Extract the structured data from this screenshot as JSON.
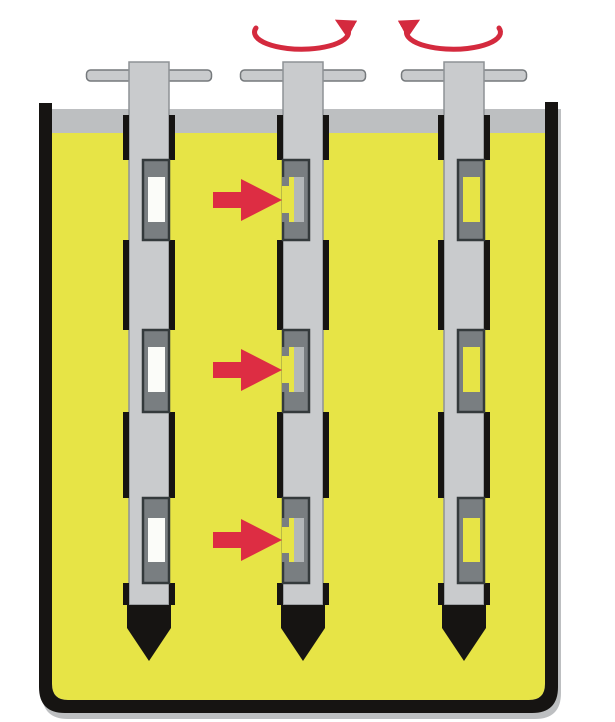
{
  "figure": {
    "kind": "slotted-sampler-in-liquid-diagram",
    "spindle_count": 3,
    "slots_per_spindle": 3,
    "flow_arrow_count": 3,
    "rotation_arrow_count": 2,
    "spindles": [
      {
        "id": "left",
        "slot_state": "closed-empty",
        "window_fill": "white"
      },
      {
        "id": "middle",
        "slot_state": "open-filling",
        "window_fill": "open",
        "icons": [
          "rotation-arrow-icon",
          "flow-arrow-icon"
        ]
      },
      {
        "id": "right",
        "slot_state": "closed-filled",
        "window_fill": "yellow",
        "icons": [
          "rotation-arrow-icon"
        ]
      }
    ]
  },
  "icons": {
    "rotation_arrow": "curved-rotation-arrow",
    "flow_arrow": "right-pointing-flow-arrow"
  },
  "colors": {
    "yellow": "#e7e446",
    "rod_gray": "#c9cbcd",
    "rod_edge": "#8e9295",
    "block_gray": "#797e81",
    "block_edge": "#343a3c",
    "ink": "#161412",
    "red": "#dd2d43",
    "red_rot": "#d42a3e",
    "white_window": "#fbfcf9",
    "mouth_gray": "#b3b7b9",
    "shadow": "#bdbfc1",
    "bg": "#ffffff"
  }
}
